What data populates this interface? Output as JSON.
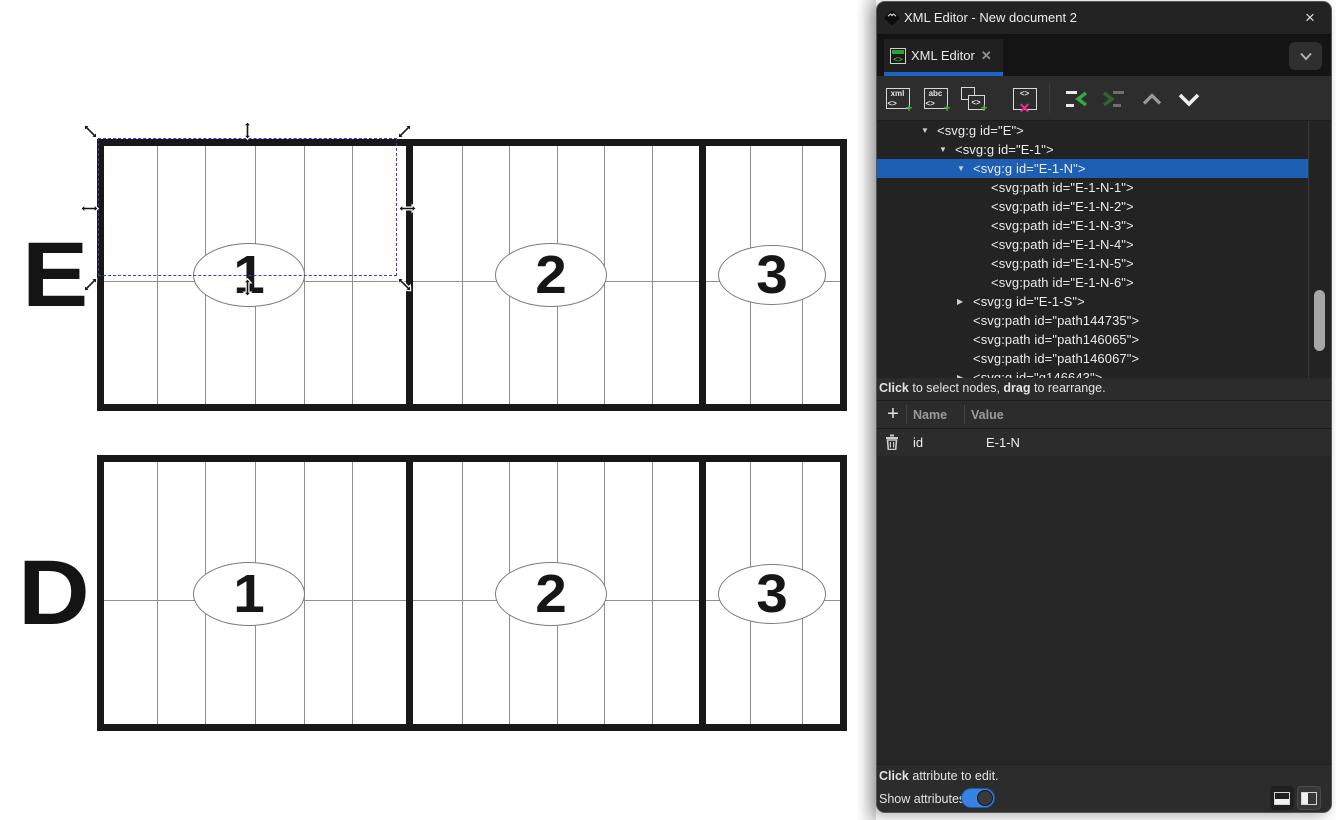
{
  "window": {
    "title": "XML Editor - New document 2",
    "close": "×"
  },
  "tabs": {
    "active": {
      "label": "XML Editor",
      "close": "✕",
      "icon_glyph": "<>"
    }
  },
  "toolbar": {
    "new_element": {
      "top": "xml",
      "left": "<>",
      "plus": "+"
    },
    "new_text": {
      "top": "abc",
      "left": "<>",
      "plus": "+"
    },
    "duplicate": {
      "glyph": "<>",
      "plus": "+"
    },
    "delete": {
      "glyph": "<>",
      "x": "✕"
    }
  },
  "tree": {
    "rows": [
      {
        "indent": 0,
        "arrow": "open",
        "text": "<svg:g id=\"E\">"
      },
      {
        "indent": 1,
        "arrow": "open",
        "text": "<svg:g id=\"E-1\">"
      },
      {
        "indent": 2,
        "arrow": "open",
        "text": "<svg:g id=\"E-1-N\">",
        "selected": true
      },
      {
        "indent": 3,
        "arrow": null,
        "text": "<svg:path id=\"E-1-N-1\">"
      },
      {
        "indent": 3,
        "arrow": null,
        "text": "<svg:path id=\"E-1-N-2\">"
      },
      {
        "indent": 3,
        "arrow": null,
        "text": "<svg:path id=\"E-1-N-3\">"
      },
      {
        "indent": 3,
        "arrow": null,
        "text": "<svg:path id=\"E-1-N-4\">"
      },
      {
        "indent": 3,
        "arrow": null,
        "text": "<svg:path id=\"E-1-N-5\">"
      },
      {
        "indent": 3,
        "arrow": null,
        "text": "<svg:path id=\"E-1-N-6\">"
      },
      {
        "indent": 2,
        "arrow": "closed",
        "text": "<svg:g id=\"E-1-S\">"
      },
      {
        "indent": 2,
        "arrow": null,
        "text": "<svg:path id=\"path144735\">"
      },
      {
        "indent": 2,
        "arrow": null,
        "text": "<svg:path id=\"path146065\">"
      },
      {
        "indent": 2,
        "arrow": null,
        "text": "<svg:path id=\"path146067\">"
      },
      {
        "indent": 2,
        "arrow": "closed",
        "text": "<svg:g id=\"g146643\">"
      }
    ],
    "hint": {
      "bold1": "Click",
      "mid": " to select nodes, ",
      "bold2": "drag",
      "end": " to rearrange."
    }
  },
  "attributes": {
    "add": "+",
    "header": {
      "name": "Name",
      "value": "Value"
    },
    "rows": [
      {
        "name": "id",
        "value": "E-1-N"
      }
    ],
    "hint": {
      "bold": "Click",
      "rest": " attribute to edit."
    },
    "show_label": "Show attributes",
    "toggle_on": true
  },
  "canvas": {
    "figures": [
      {
        "label": "E",
        "numbers": [
          "1",
          "2",
          "3"
        ]
      },
      {
        "label": "D",
        "numbers": [
          "1",
          "2",
          "3"
        ]
      }
    ]
  },
  "colors": {
    "accent_blue": "#1c64c8",
    "selection_blue": "#1d5fb2",
    "toggle_blue": "#3584e4",
    "plus_green": "#3fae3f",
    "delete_pink": "#ee2d87"
  }
}
